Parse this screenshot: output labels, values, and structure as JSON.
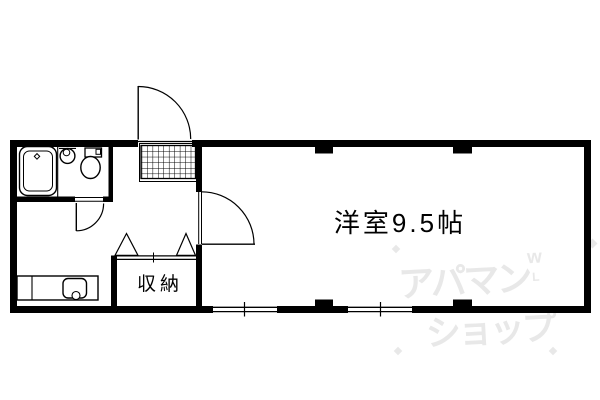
{
  "labels": {
    "main_room": "洋室9.5帖",
    "closet": "収納"
  },
  "watermark": {
    "line1": "アパマン",
    "line2": "ショップ",
    "mark_top": "w",
    "mark_bottom": "L",
    "color": "#e8e8e8"
  },
  "colors": {
    "line": "#000000",
    "background": "#ffffff"
  }
}
